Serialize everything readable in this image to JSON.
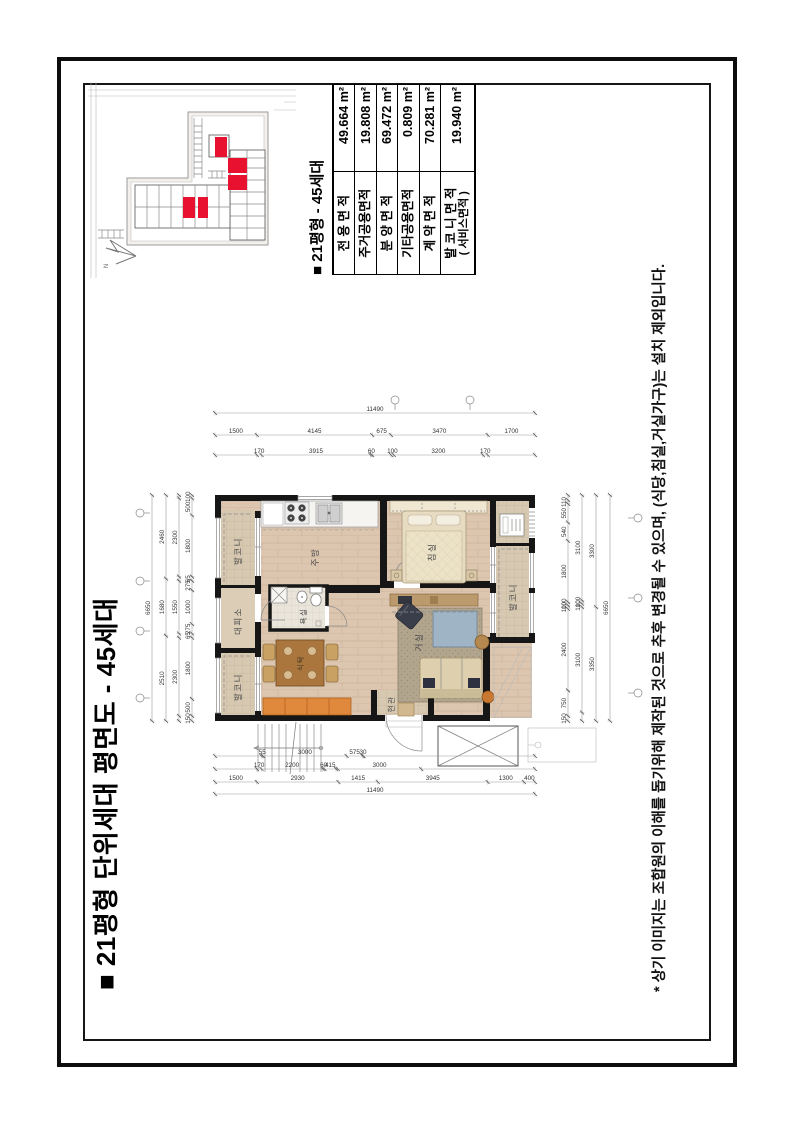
{
  "page": {
    "title": "■ 21평형 단위세대 평면도 - 45세대",
    "disclaimer": "* 상기 이미지는 조합원의 이해를 돕기위해 제작된 것으로 추후 변경될 수 있으며, (식당,침실,거실가구)는 설치 제외입니다."
  },
  "summary": {
    "title": "■ 21평형 - 45세대",
    "rows": [
      {
        "label": "전 용 면 적",
        "value": "49.664 m²"
      },
      {
        "label": "주거공용면적",
        "value": "19.808 m²"
      },
      {
        "label": "분 양 면 적",
        "value": "69.472 m²"
      },
      {
        "label": "기타공용면적",
        "value": "0.809 m²"
      },
      {
        "label": "계 약 면 적",
        "value": "70.281 m²"
      },
      {
        "label": "발 코 니 면 적",
        "label2": "( 서비스면적 )",
        "value": "19.940 m²"
      }
    ]
  },
  "site_plan": {
    "north_label": "N",
    "unit_highlight_color": "#e81230"
  },
  "floor_plan": {
    "rooms": {
      "balcony_top_left": "발코니",
      "shelter": "대피소",
      "balcony_top_right": "발코니",
      "kitchen": "주방",
      "dining_table": "식탁",
      "bathroom": "욕실",
      "living": "거실",
      "bedroom": "침실",
      "balcony_bottom": "발코니",
      "entrance": "현관"
    },
    "chains": {
      "top": {
        "total": 6650,
        "rows": [
          [
            [
              6650,
              "6650"
            ]
          ],
          [
            [
              2510,
              "2510"
            ],
            [
              1680,
              "1680"
            ],
            [
              2460,
              "2460"
            ]
          ],
          [
            [
              150,
              ""
            ],
            [
              2300,
              "2300"
            ],
            [
              125,
              ""
            ],
            [
              1550,
              "1550"
            ],
            [
              125,
              ""
            ],
            [
              2300,
              "2300"
            ],
            [
              100,
              ""
            ]
          ],
          [
            [
              150,
              "150"
            ],
            [
              500,
              "500"
            ],
            [
              1800,
              "1800"
            ],
            [
              125,
              "65"
            ],
            [
              275,
              "275"
            ],
            [
              1000,
              "1000"
            ],
            [
              275,
              "275"
            ],
            [
              125,
              "65"
            ],
            [
              1800,
              "1800"
            ],
            [
              500,
              "500"
            ],
            [
              100,
              "100"
            ]
          ]
        ]
      },
      "bottom": {
        "total": 6650,
        "rows": [
          [
            [
              150,
              "150"
            ],
            [
              750,
              "750"
            ],
            [
              2400,
              "2400"
            ],
            [
              100,
              "100"
            ],
            [
              100,
              "100"
            ],
            [
              1800,
              "1800"
            ],
            [
              540,
              "540"
            ],
            [
              550,
              "550"
            ],
            [
              110,
              "110"
            ],
            [
              150,
              ""
            ]
          ],
          [
            [
              250,
              ""
            ],
            [
              3100,
              "3100"
            ],
            [
              100,
              "100"
            ],
            [
              100,
              "100"
            ],
            [
              3100,
              "3100"
            ]
          ],
          [
            [
              3350,
              "3350"
            ],
            [
              3300,
              "3300"
            ]
          ],
          [
            [
              6650,
              "6650"
            ]
          ]
        ]
      },
      "left": {
        "total": 11490,
        "rows": [
          [
            [
              1670,
              ""
            ],
            [
              55,
              "55"
            ],
            [
              3000,
              "3000"
            ],
            [
              575,
              "575"
            ],
            [
              30,
              "30"
            ],
            [
              6160,
              ""
            ]
          ],
          [
            [
              1500,
              ""
            ],
            [
              170,
              "170"
            ],
            [
              2200,
              "2200"
            ],
            [
              60,
              "60"
            ],
            [
              415,
              "415"
            ],
            [
              60,
              ""
            ],
            [
              3000,
              "3000"
            ],
            [
              4085,
              ""
            ]
          ],
          [
            [
              1500,
              "1500"
            ],
            [
              2930,
              "2930"
            ],
            [
              1415,
              "1415"
            ],
            [
              3945,
              "3945"
            ],
            [
              1300,
              "1300"
            ],
            [
              400,
              "400"
            ]
          ],
          [
            [
              11490,
              "11490"
            ]
          ]
        ]
      },
      "right": {
        "total": 11490,
        "rows": [
          [
            [
              1500,
              ""
            ],
            [
              170,
              "170"
            ],
            [
              3915,
              "3915"
            ],
            [
              60,
              "60"
            ],
            [
              675,
              ""
            ],
            [
              100,
              "100"
            ],
            [
              3200,
              "3200"
            ],
            [
              170,
              "170"
            ],
            [
              1700,
              ""
            ]
          ],
          [
            [
              1500,
              "1500"
            ],
            [
              4145,
              "4145"
            ],
            [
              675,
              "675"
            ],
            [
              3470,
              "3470"
            ],
            [
              1700,
              "1700"
            ]
          ],
          [
            [
              11490,
              "11490"
            ]
          ]
        ]
      }
    }
  }
}
